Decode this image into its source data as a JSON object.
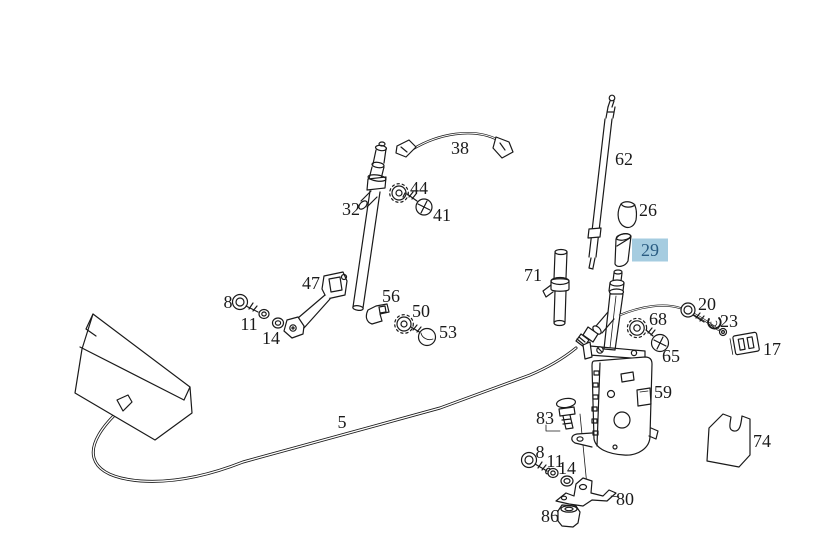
{
  "diagram": {
    "background": "#ffffff",
    "line_color": "#1a1a1a",
    "label_color": "#1a1a1a",
    "highlight_bg": "#a5cce0",
    "highlight_text": "#2a5c82",
    "selected_part": "29",
    "labels": [
      {
        "id": "part-label-38",
        "text": "38",
        "x": 460,
        "y": 148,
        "highlighted": false
      },
      {
        "id": "part-label-62",
        "text": "62",
        "x": 624,
        "y": 159,
        "highlighted": false
      },
      {
        "id": "part-label-26",
        "text": "26",
        "x": 648,
        "y": 210,
        "highlighted": false
      },
      {
        "id": "part-label-29",
        "text": "29",
        "x": 650,
        "y": 250,
        "highlighted": true
      },
      {
        "id": "part-label-32",
        "text": "32",
        "x": 351,
        "y": 209,
        "highlighted": false
      },
      {
        "id": "part-label-44",
        "text": "44",
        "x": 419,
        "y": 188,
        "highlighted": false
      },
      {
        "id": "part-label-41",
        "text": "41",
        "x": 442,
        "y": 215,
        "highlighted": false
      },
      {
        "id": "part-label-71",
        "text": "71",
        "x": 533,
        "y": 275,
        "highlighted": false
      },
      {
        "id": "part-label-47",
        "text": "47",
        "x": 311,
        "y": 283,
        "highlighted": false
      },
      {
        "id": "part-label-8-left",
        "text": "8",
        "x": 228,
        "y": 302,
        "highlighted": false
      },
      {
        "id": "part-label-11-left",
        "text": "11",
        "x": 249,
        "y": 324,
        "highlighted": false
      },
      {
        "id": "part-label-14-left",
        "text": "14",
        "x": 271,
        "y": 338,
        "highlighted": false
      },
      {
        "id": "part-label-56",
        "text": "56",
        "x": 391,
        "y": 296,
        "highlighted": false
      },
      {
        "id": "part-label-50",
        "text": "50",
        "x": 421,
        "y": 311,
        "highlighted": false
      },
      {
        "id": "part-label-53",
        "text": "53",
        "x": 448,
        "y": 332,
        "highlighted": false
      },
      {
        "id": "part-label-20",
        "text": "20",
        "x": 707,
        "y": 304,
        "highlighted": false
      },
      {
        "id": "part-label-23",
        "text": "23",
        "x": 729,
        "y": 321,
        "highlighted": false
      },
      {
        "id": "part-label-68",
        "text": "68",
        "x": 658,
        "y": 319,
        "highlighted": false
      },
      {
        "id": "part-label-65",
        "text": "65",
        "x": 671,
        "y": 356,
        "highlighted": false
      },
      {
        "id": "part-label-17",
        "text": "17",
        "x": 772,
        "y": 349,
        "highlighted": false
      },
      {
        "id": "part-label-59",
        "text": "59",
        "x": 663,
        "y": 392,
        "highlighted": false
      },
      {
        "id": "part-label-5",
        "text": "5",
        "x": 342,
        "y": 422,
        "highlighted": false
      },
      {
        "id": "part-label-83",
        "text": "83",
        "x": 545,
        "y": 418,
        "highlighted": false
      },
      {
        "id": "part-label-8-lower",
        "text": "8",
        "x": 540,
        "y": 452,
        "highlighted": false
      },
      {
        "id": "part-label-11-lower",
        "text": "11",
        "x": 555,
        "y": 461,
        "highlighted": false
      },
      {
        "id": "part-label-14-lower",
        "text": "14",
        "x": 567,
        "y": 468,
        "highlighted": false
      },
      {
        "id": "part-label-80",
        "text": "80",
        "x": 625,
        "y": 499,
        "highlighted": false
      },
      {
        "id": "part-label-86",
        "text": "86",
        "x": 550,
        "y": 516,
        "highlighted": false
      },
      {
        "id": "part-label-74",
        "text": "74",
        "x": 762,
        "y": 441,
        "highlighted": false
      }
    ]
  }
}
